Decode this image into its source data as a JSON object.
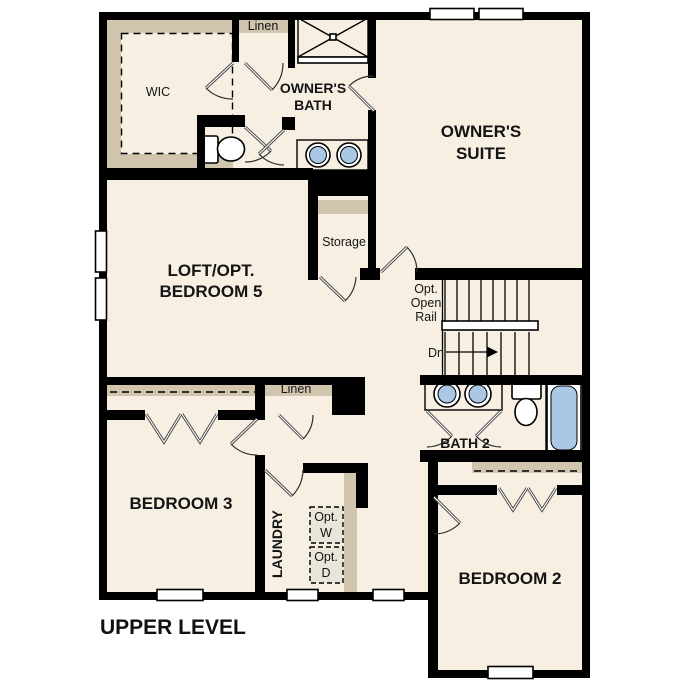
{
  "plan": {
    "title": "UPPER LEVEL",
    "labels": {
      "wic": "WIC",
      "linen_top": "Linen",
      "owners_bath_1": "OWNER'S",
      "owners_bath_2": "BATH",
      "owners_suite_1": "OWNER'S",
      "owners_suite_2": "SUITE",
      "loft_1": "LOFT/OPT.",
      "loft_2": "BEDROOM 5",
      "storage": "Storage",
      "opt_rail_1": "Opt.",
      "opt_rail_2": "Open",
      "opt_rail_3": "Rail",
      "down": "Dn",
      "bath2": "BATH 2",
      "linen_hall": "Linen",
      "bedroom3": "BEDROOM 3",
      "laundry": "LAUNDRY",
      "opt_washer_1": "Opt.",
      "opt_washer_2": "W",
      "opt_dryer_1": "Opt.",
      "opt_dryer_2": "D",
      "bedroom2": "BEDROOM 2"
    },
    "colors": {
      "background": "#ffffff",
      "floor": "#f6efe2",
      "wall": "#000000",
      "casework_tan": "#d1c5ae",
      "fixture_blue": "#aac8e6",
      "optional_appliance": "#e9e5da"
    }
  }
}
